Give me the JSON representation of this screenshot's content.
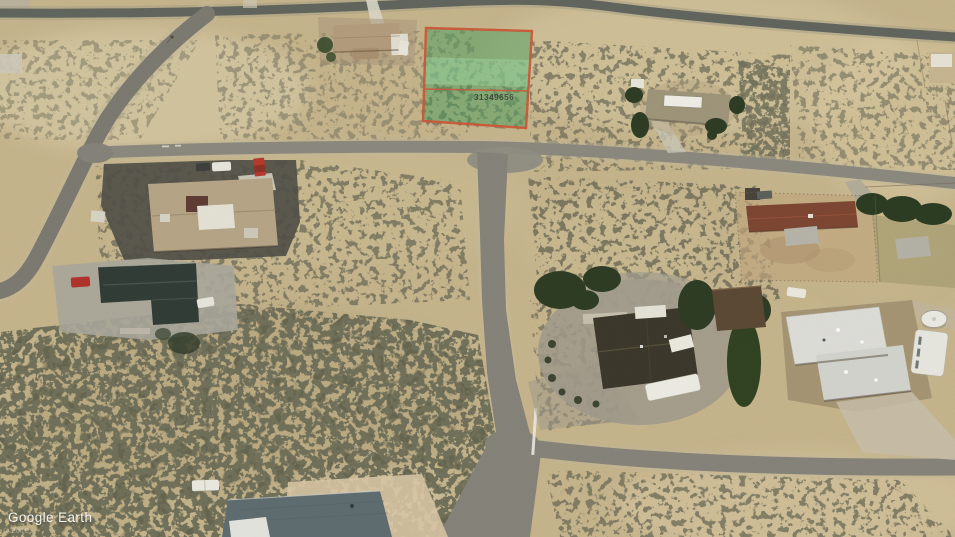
{
  "watermark": {
    "logo": "Google Earth",
    "copyright": "© 2018"
  },
  "parcel_overlay": {
    "label": "31349656",
    "fill_color": "#46a05e",
    "band_color": "#9fd8a4",
    "border_color": "#cd5637",
    "label_color": "#323c33"
  },
  "terrain": {
    "sand_color": "#c7b68d",
    "road_color": "#85837a",
    "shrub_color": "#30301f",
    "asphalt_color": "#4f4e46"
  }
}
